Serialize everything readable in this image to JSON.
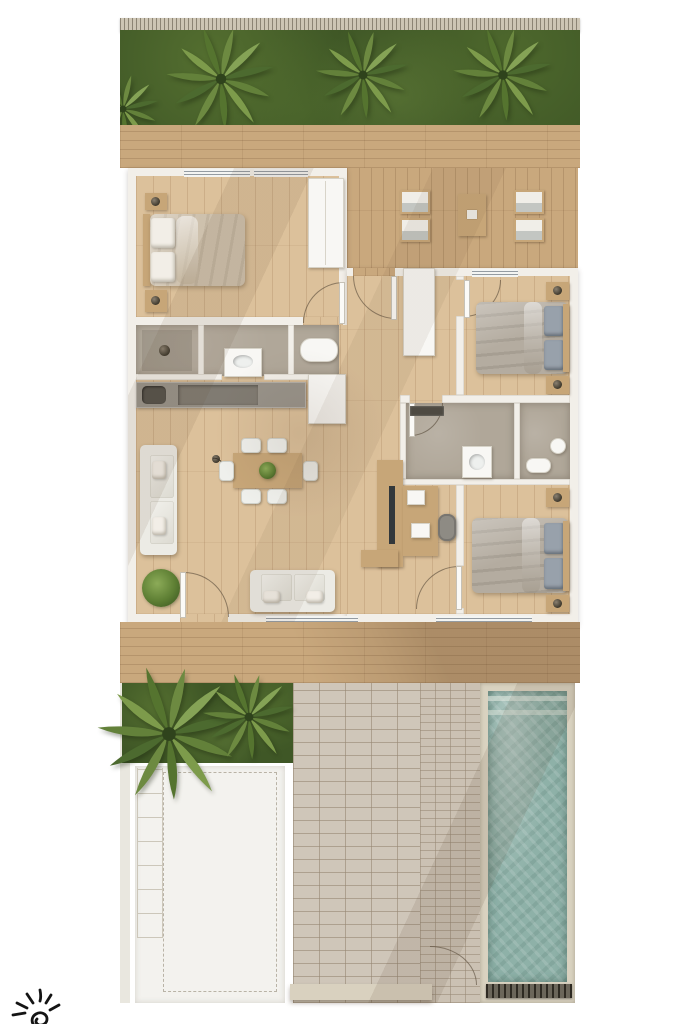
{
  "meta": {
    "title": "Top-down 3D rendered floor plan of a three-bedroom villa with deck, brick patio, parking pad and lap pool",
    "type": "architectural-floor-plan-render",
    "visible_text": "none"
  },
  "colors": {
    "page_bg": "#ffffff",
    "fence": "#cdc5b4",
    "grass": "#3f5726",
    "deck_wood": "#c9a87d",
    "floor_wood": "#dcc19b",
    "wall": "#f2efe9",
    "wall_edge": "#cfcabf",
    "bath_floor": "#b0a799",
    "counter": "#98938a",
    "fixture_white": "#f8f7f4",
    "duvet_beige": "#cec1ad",
    "pillow_white": "#f2eee7",
    "duvet_gray": "#b4aca0",
    "pillow_gray": "#98a1ab",
    "sofa": "#ecebe5",
    "table_wood": "#c7a678",
    "chair_white": "#eff0ec",
    "pool_water": "#8eb1a8",
    "pool_coping": "#d9d2c0",
    "brick": "#cfc6b9",
    "brick2": "#cbc1b3",
    "parking": "#f3f2ee",
    "dash_line": "#b9b3a6",
    "tile_line": "#ccc7ba",
    "logo_ink": "#141414"
  },
  "rooms": {
    "bedroom1": {
      "label": "Bedroom 1 (master) — double bed, two nightstands with lamps, wardrobe"
    },
    "masterBath": {
      "label": "Master bathroom — walk-in shower, vanity sink, bathtub"
    },
    "kitchen": {
      "label": "Kitchen counter — sink, cooktop, tall cabinet"
    },
    "living": {
      "label": "Living room — sofa, loveseat, floor lamp, potted plant"
    },
    "dining": {
      "label": "Dining area — table for six with plant centerpiece"
    },
    "hallway": {
      "label": "Hallway — built-in closet and sideboard"
    },
    "office": {
      "label": "Work nook — desk, laptop, office chair, TV console"
    },
    "bedroom2": {
      "label": "Bedroom 2 — double bed, two nightstands with lamps"
    },
    "bathroom2": {
      "label": "Bathroom 2 — shower shelf and sink"
    },
    "bathroom3": {
      "label": "Bathroom 3 (en-suite) — toilet and round sink"
    },
    "bedroom3": {
      "label": "Bedroom 3 — double bed, two nightstands with lamps"
    }
  },
  "outdoor": {
    "fence": {
      "label": "Rear boundary fence"
    },
    "gardenTop": {
      "label": "Back garden strip with three palm trees",
      "palms": 3
    },
    "deckTop": {
      "label": "Back wood deck"
    },
    "terrace": {
      "label": "Terrace seating — four chairs and a side table"
    },
    "deckBottom": {
      "label": "Front wood deck"
    },
    "gardenFront": {
      "label": "Front garden with palm cluster",
      "palms": 2
    },
    "parking": {
      "label": "Parking pad with dashed marking and paver strip"
    },
    "patio": {
      "label": "Brick patio walkway with gate"
    },
    "pool": {
      "label": "Lap pool with entry steps and overflow grate"
    }
  },
  "logo": {
    "label": "Hand-drawn black sun doodle watermark (bottom-left corner)"
  }
}
